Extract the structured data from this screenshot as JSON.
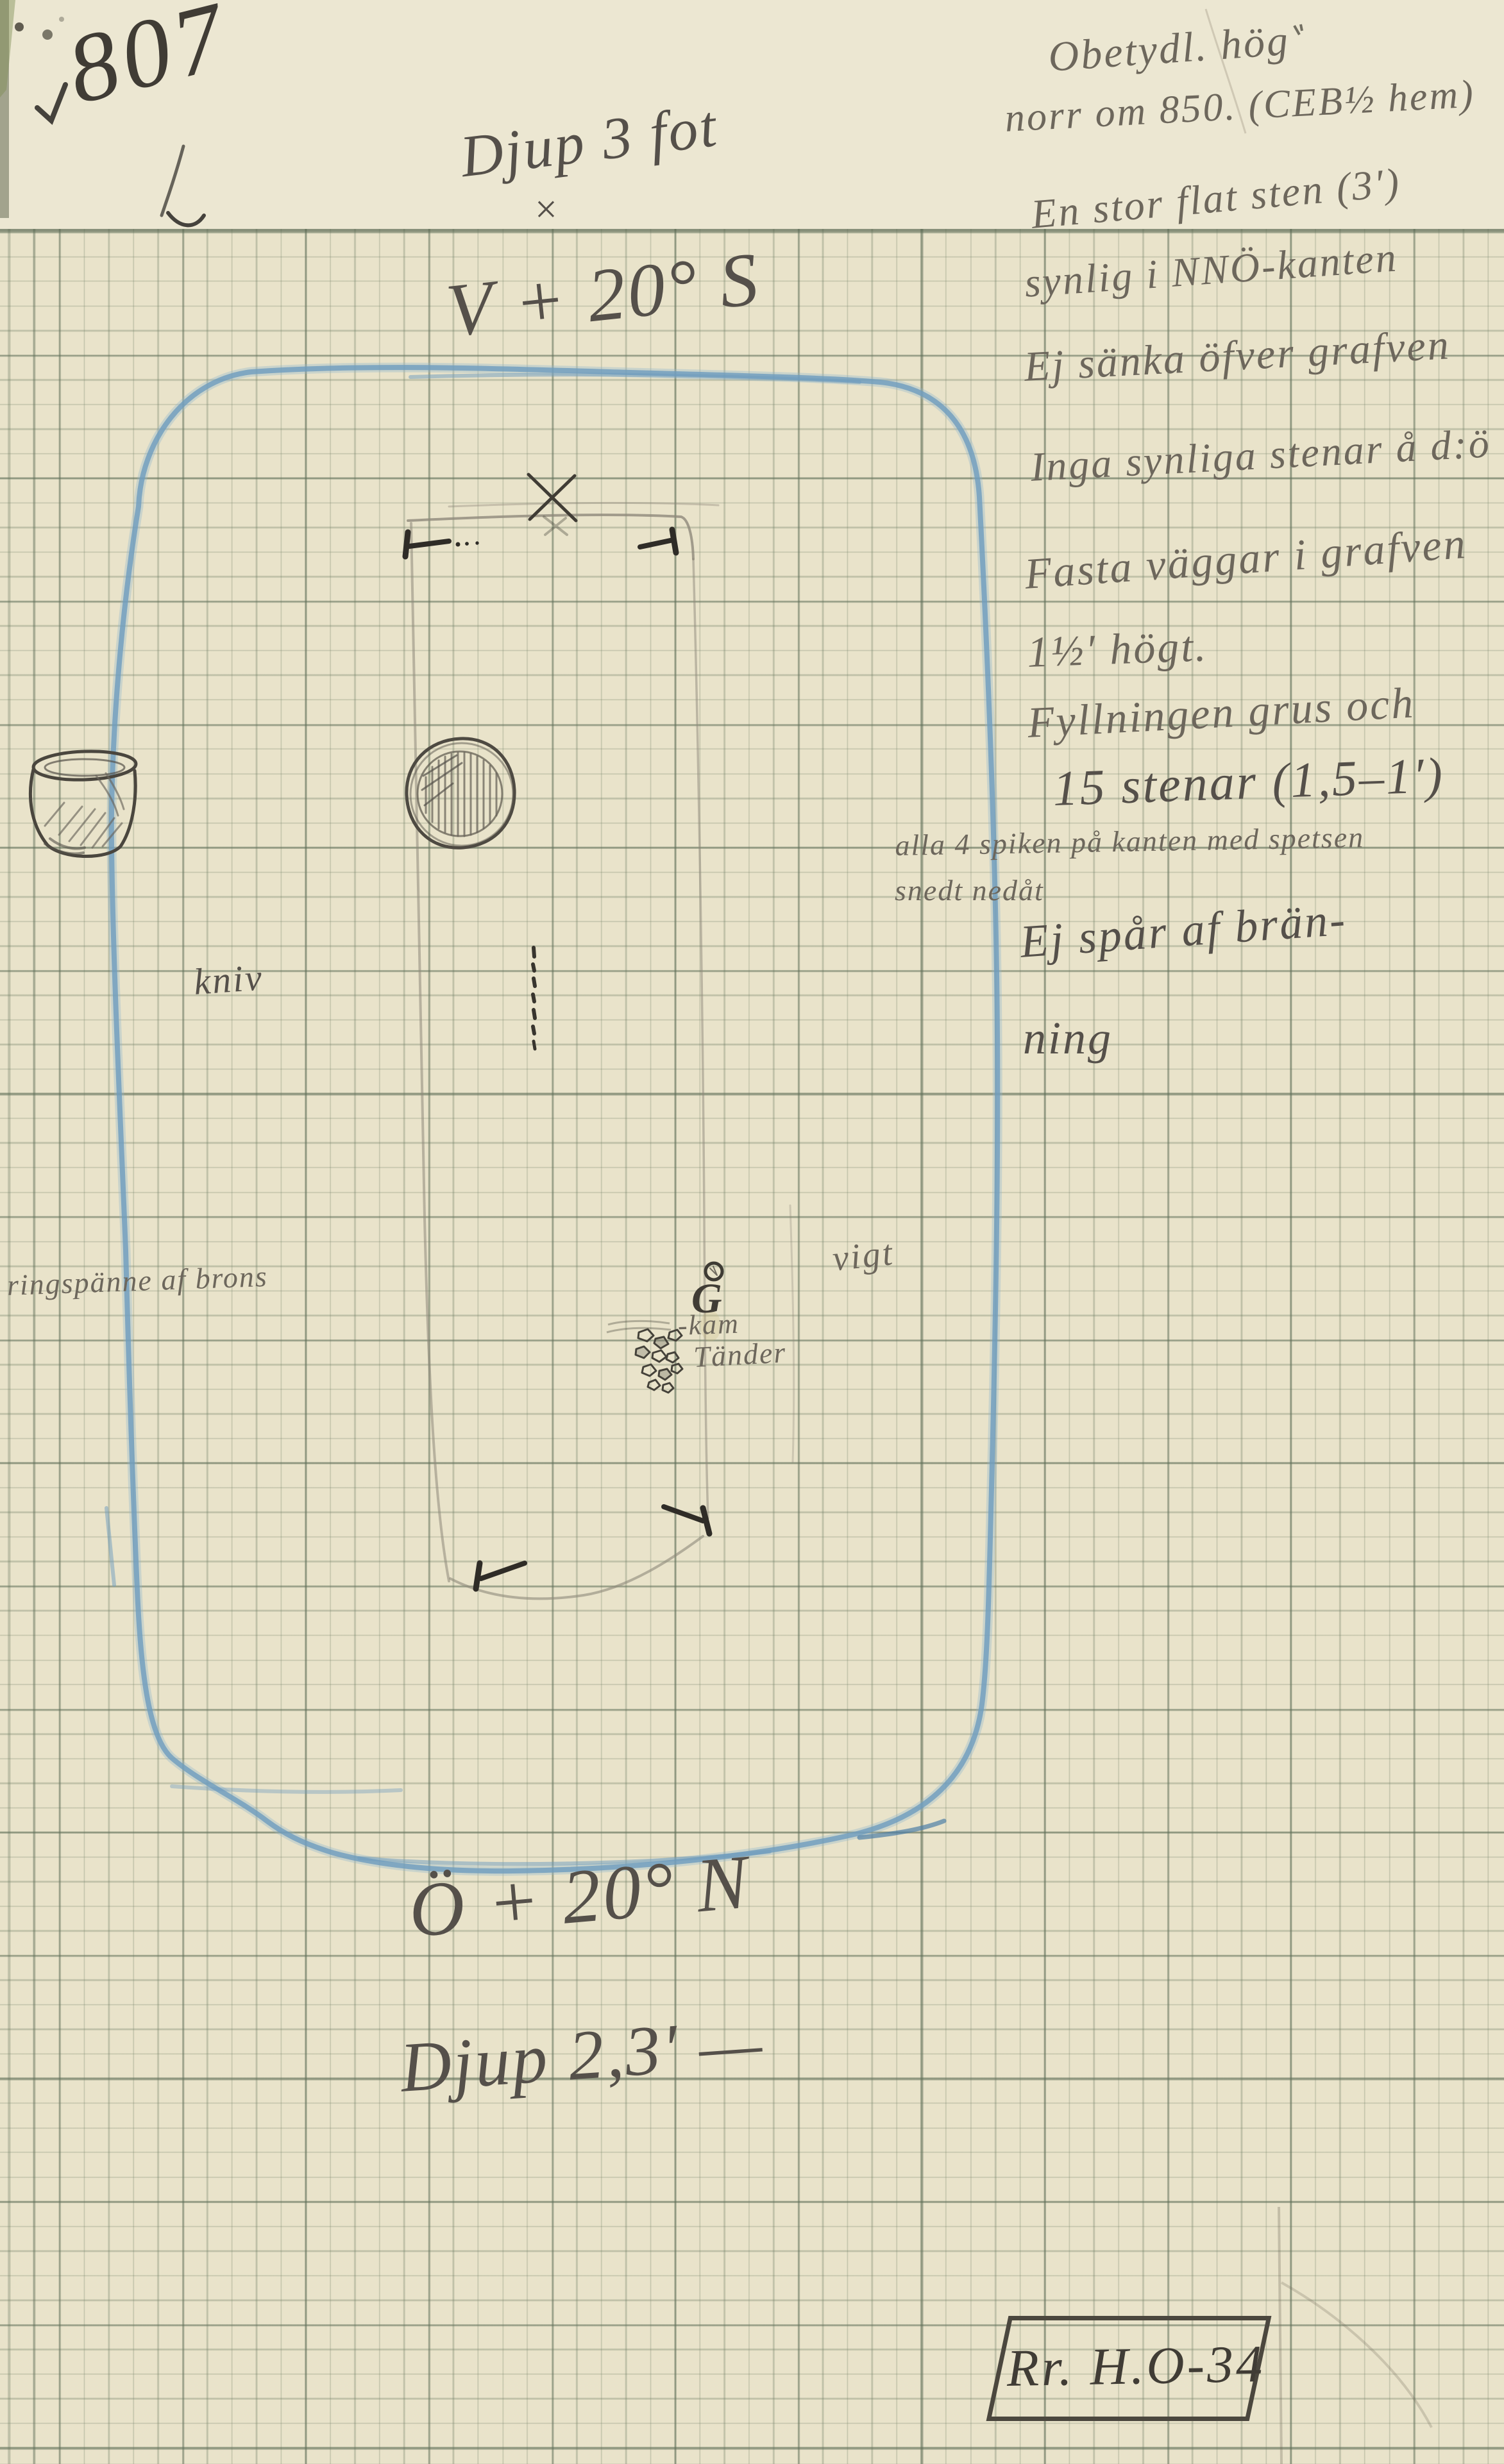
{
  "header": {
    "grave_number": "807",
    "depth_note": "Djup 3 fot",
    "cross_mark": "×",
    "orientation_west": "V + 20° S"
  },
  "footer": {
    "orientation_east": "Ö + 20° N",
    "depth_note": "Djup 2,3′ —",
    "reference_label": "Rr. H.O-34"
  },
  "notes_right": {
    "line01": "Obetydl. hög",
    "line02": "norr om 850. (CEB½ hem)",
    "line03": "En stor flat sten (3′)",
    "line04": "synlig i NNÖ-kanten",
    "line05": "Ej sänka öfver grafven",
    "line06": "Inga synliga stenar å d:ö",
    "line07": "Fasta väggar i grafven",
    "line08": "1½′ högt.",
    "line09": "Fyllningen grus och",
    "line10": "15 stenar (1,5–1′)"
  },
  "notes_nails": {
    "line1": "alla 4 spiken på kanten med spetsen",
    "line2": "snedt nedåt"
  },
  "notes_burning": {
    "line1": "Ej spår af brän-",
    "line2": "ning"
  },
  "find_labels": {
    "knife": "kniv",
    "ring_brooch": "ringspänne af brons",
    "weight": "vigt",
    "comb": "-kam",
    "teeth": "Tänder",
    "g_mark": "G"
  },
  "colors": {
    "blue_pencil": "#6e9cbe",
    "graphite": "#55504a",
    "paper": "#e9e3ca"
  }
}
